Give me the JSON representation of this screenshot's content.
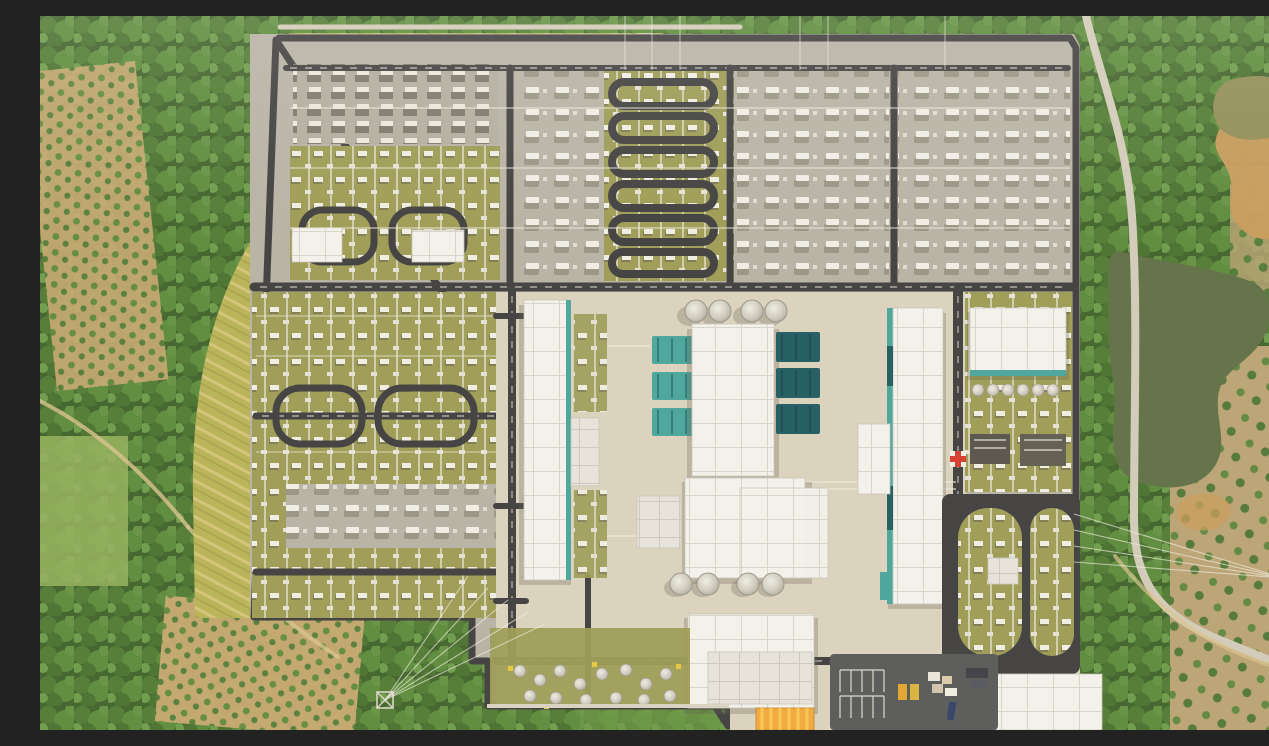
{
  "scene": {
    "type": "aerial-photograph",
    "description": "Top-down aerial drone photograph of a large HVDC converter station and high-voltage switchyard complex set in hilly countryside, surrounded by dense forest, terraced orchards, ponds and rural dirt roads",
    "time_of_day": "midday, soft haze",
    "no_visible_text": true
  },
  "labels": {
    "photo": "aerial photo of converter station",
    "surroundings": "forest, orchards, ponds and rural roads around the site",
    "forest": "dense forest canopy",
    "orchards": "terraced orchard rows on bare soil",
    "slope": "terraced grass embankment along the west fence",
    "pond_northeast": "muddy pond north-east of the site",
    "pond_east": "long dark pond east of the site",
    "access_road_east": "light concrete access road along east side",
    "site": "walled converter-station site",
    "perimeter_road": "dark perimeter road inside the fence",
    "north_switchyard": "north AC switchyard with breaker bays and U-loop service roads",
    "west_switchyard": "west switchyard with lattice gantries and loop roads",
    "valve_hall_west": "west valve hall with teal transformer bays",
    "valve_hall_center": "central valve-hall complex with converter transformer bays",
    "valve_hall_east": "east valve hall with teal transformer bays",
    "northeast_building": "north-east service hall with tank row",
    "cooling_tanks": "round cooling tanks",
    "tank_farm": "cluster of small white storage tanks",
    "control_building": "bottom control / service building",
    "southeast_building": "south-east service hall",
    "parking": "striped parking lot with trucks and laydown material",
    "yellow_building": "yellow-roofed storage shed",
    "helimark": "red-and-white cross road marking",
    "dark_yard": "dark paved yard with stadium-shaped equipment islands",
    "towers": "transmission towers with incoming overhead lines"
  },
  "palette": {
    "forestDark": "#3e6129",
    "forestMid": "#527c33",
    "forestLight": "#6d9a46",
    "meadow": "#93b05c",
    "soil": "#c6a76f",
    "soilBare": "#c89a5a",
    "slope": "#b7b356",
    "terraceLine": "#d2c377",
    "gravel": "#b6b2a5",
    "gravelDark": "#8d8879",
    "olive": "#9b9a53",
    "asphalt": "#3d3d3d",
    "concrete": "#dbd2be",
    "roof": "#f3f2ed",
    "roofLine": "#d7d4cc",
    "roofDim": "#e6e3dc",
    "tealLight": "#46a49b",
    "tealDark": "#1c5a5f",
    "pond": "#8f8c55",
    "river": "#5e6e45",
    "lightRoad": "#d2cbba",
    "dirtRoad": "#d8c28c",
    "yellowRoof": "#f2a83b",
    "yellowStripe": "#f6c84f",
    "redMarker": "#d43a2e",
    "white": "#f2f0e8"
  },
  "object_counts": {
    "round_cooling_tanks_top": 4,
    "round_cooling_tanks_bottom": 4,
    "tank_row_northeast": 6,
    "teal_bays_center_left": 3,
    "teal_bays_center_right": 3,
    "north_yard_loop_roads": 6,
    "transmission_towers_visible": 2
  }
}
